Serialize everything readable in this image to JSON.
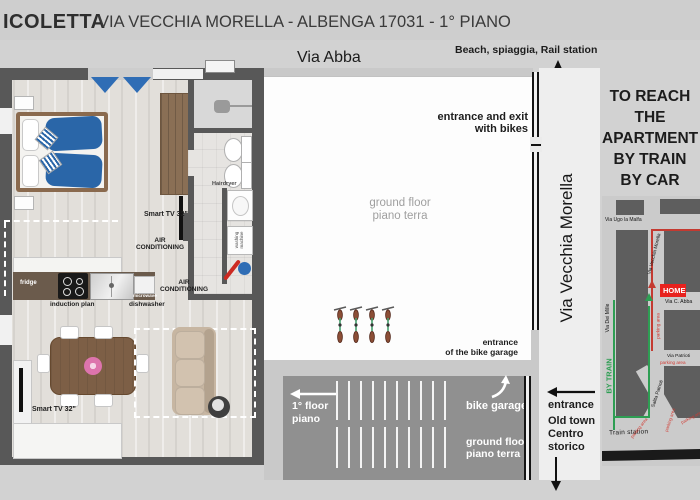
{
  "header": {
    "brand": "ICOLETTA",
    "subtitle": "VIA VECCHIA MORELLA - ALBENGA 17031 - 1° PIANO"
  },
  "plan": {
    "via_abba": "Via Abba",
    "beach_note": "Beach, spiaggia, Rail station",
    "via_vecchia_morella": "Via Vecchia Morella",
    "entrance_exit_l1": "entrance and exit",
    "entrance_exit_l2": "with bikes",
    "courtyard_l1": "ground floor",
    "courtyard_l2": "piano terra",
    "bike_entrance_l1": "entrance",
    "bike_entrance_l2": "of the bike garage",
    "corridor_floor_l1": "1° floor",
    "corridor_floor_l2": "piano",
    "bike_garage": "bike garage",
    "corridor_ground_l1": "ground floor",
    "corridor_ground_l2": "piano terra",
    "entrance": "entrance",
    "old_town_l1": "Old town",
    "old_town_l2": "Centro",
    "old_town_l3": "storico"
  },
  "apartment": {
    "tv_bedroom": "Smart TV 32\"",
    "tv_living": "Smart TV 32\"",
    "ac_l1": "AIR",
    "ac_l2": "CONDITIONING",
    "hairdryer": "Hairdryer",
    "washing_machine": "washing machine",
    "fridge": "fridge",
    "induction": "induction plan",
    "microwave": "microwave",
    "dishwasher": "dishwasher"
  },
  "directions": {
    "l1": "TO REACH",
    "l2": "THE",
    "l3": "APARTMENT",
    "l4": "BY TRAIN",
    "l5": "BY CAR"
  },
  "map": {
    "via_ugo": "Via Ugo la Malfa",
    "via_vecchia_morella": "Via Vecchia Morella",
    "via_abba": "Via C. Abba",
    "via_mille": "Via Dei Mille",
    "via_patrioti": "Via Patrioti",
    "salita_patrioti": "Salita Patrioti",
    "home": "HOME",
    "by_train": "BY TRAIN",
    "train_station": "Train station",
    "parking": "parking area",
    "colors": {
      "home_bg": "#e8211d",
      "route_car": "#c43a31",
      "route_train": "#2e9e53",
      "bed_blue": "#2a66a8"
    }
  }
}
